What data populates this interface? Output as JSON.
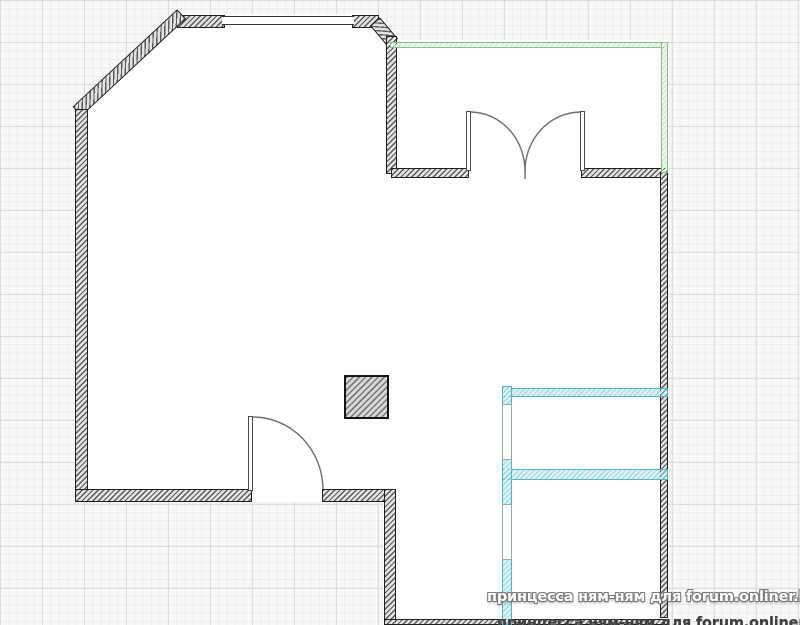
{
  "page": {
    "type": "apartment-floor-plan",
    "description": "Floor plan drawing on grid paper with hatched walls, green balcony wall, cyan partition walls, two doors and a column"
  },
  "watermark": {
    "line1": "принцесса ням-ням для forum.onliner.by",
    "line2": "принцесса ням-ням для forum.onliner.by"
  },
  "colors": {
    "bg": "#f8f8f6",
    "grid_minor": "#ececea",
    "grid_major": "#dcdcdb",
    "floor": "#ffffff",
    "wall_dark": "#3a3a3a",
    "green": "#8abf8a",
    "cyan": "#55b2bf"
  },
  "plan": {
    "canvas": {
      "w": 800,
      "h": 625
    },
    "floor_outline": [
      [
        75,
        111
      ],
      [
        179,
        14
      ],
      [
        375,
        14
      ],
      [
        397,
        40
      ],
      [
        668,
        40
      ],
      [
        668,
        625
      ],
      [
        383,
        625
      ],
      [
        383,
        502
      ],
      [
        75,
        502
      ]
    ],
    "walls": [
      {
        "name": "wall-top-left-segment",
        "kind": "dark",
        "x": 177,
        "y": 15,
        "w": 48,
        "h": 13
      },
      {
        "name": "wall-top-right-segment",
        "kind": "dark",
        "x": 352,
        "y": 15,
        "w": 27,
        "h": 13
      },
      {
        "name": "wall-chamfer",
        "kind": "dark",
        "x": 77,
        "y": 105,
        "w": 143,
        "h": 13,
        "rotate": -43
      },
      {
        "name": "wall-mini-chamfer",
        "kind": "dark",
        "x": 375,
        "y": 15,
        "w": 28,
        "h": 13,
        "rotate": 50
      },
      {
        "name": "wall-entry-vertical",
        "kind": "dark",
        "x": 386,
        "y": 36,
        "w": 11,
        "h": 138
      },
      {
        "name": "wall-balcony-bottom-left",
        "kind": "dark",
        "x": 391,
        "y": 168,
        "w": 78,
        "h": 10
      },
      {
        "name": "wall-balcony-bottom-right",
        "kind": "dark",
        "x": 581,
        "y": 168,
        "w": 87,
        "h": 10
      },
      {
        "name": "wall-right",
        "kind": "dark",
        "x": 660,
        "y": 172,
        "w": 8,
        "h": 446
      },
      {
        "name": "wall-left",
        "kind": "dark",
        "x": 75,
        "y": 109,
        "w": 13,
        "h": 393
      },
      {
        "name": "wall-bottom-left-segment",
        "kind": "dark",
        "x": 75,
        "y": 489,
        "w": 177,
        "h": 13
      },
      {
        "name": "wall-bottom-mid-segment",
        "kind": "dark",
        "x": 322,
        "y": 489,
        "w": 74,
        "h": 13
      },
      {
        "name": "wall-step-vertical",
        "kind": "dark",
        "x": 384,
        "y": 489,
        "w": 12,
        "h": 136
      },
      {
        "name": "wall-bottom-edge",
        "kind": "dark",
        "x": 384,
        "y": 619,
        "w": 284,
        "h": 6
      },
      {
        "name": "wall-green-top",
        "kind": "green",
        "x": 390,
        "y": 42,
        "w": 278,
        "h": 6
      },
      {
        "name": "wall-green-right",
        "kind": "green",
        "x": 661,
        "y": 42,
        "w": 7,
        "h": 131
      },
      {
        "name": "wall-cyan-horizontal-upper",
        "kind": "cyan",
        "x": 502,
        "y": 388,
        "w": 166,
        "h": 9
      },
      {
        "name": "wall-cyan-horizontal-lower",
        "kind": "cyan",
        "x": 502,
        "y": 469,
        "w": 166,
        "h": 11
      },
      {
        "name": "wall-cyan-vertical-top",
        "kind": "cyan",
        "x": 502,
        "y": 386,
        "w": 10,
        "h": 20
      },
      {
        "name": "wall-cyan-vertical-mid",
        "kind": "cyan",
        "x": 502,
        "y": 458,
        "w": 10,
        "h": 47
      },
      {
        "name": "wall-cyan-vertical-bottom",
        "kind": "cyan",
        "x": 502,
        "y": 559,
        "w": 10,
        "h": 66
      }
    ],
    "windows": [
      {
        "name": "window-top-wall",
        "orient": "h",
        "x": 222,
        "y": 16,
        "w": 132,
        "h": 9
      },
      {
        "name": "window-cyan-upper",
        "orient": "v",
        "x": 502,
        "y": 404,
        "w": 10,
        "h": 56
      },
      {
        "name": "window-cyan-lower",
        "orient": "v",
        "x": 502,
        "y": 504,
        "w": 10,
        "h": 56
      }
    ],
    "door_leaves": [
      {
        "name": "double-door-left-leaf",
        "x": 466,
        "y": 111,
        "w": 5,
        "h": 60
      },
      {
        "name": "double-door-right-leaf",
        "x": 580,
        "y": 111,
        "w": 5,
        "h": 60
      },
      {
        "name": "single-door-leaf",
        "x": 248,
        "y": 416,
        "w": 5,
        "h": 75
      }
    ],
    "door_arcs": [
      {
        "name": "double-door-left-arc",
        "d": "M 471,112 A 55,59 0 0 1 525,171"
      },
      {
        "name": "double-door-right-arc",
        "d": "M 580,112 A 56,59 0 0 0 525,171"
      },
      {
        "name": "double-door-center-stub",
        "d": "M 525,171 L 525,179"
      },
      {
        "name": "single-door-arc",
        "d": "M 253,417 A 70,73 0 0 1 323,489"
      }
    ],
    "column": {
      "name": "column",
      "x": 344,
      "y": 375,
      "w": 45,
      "h": 44
    }
  }
}
